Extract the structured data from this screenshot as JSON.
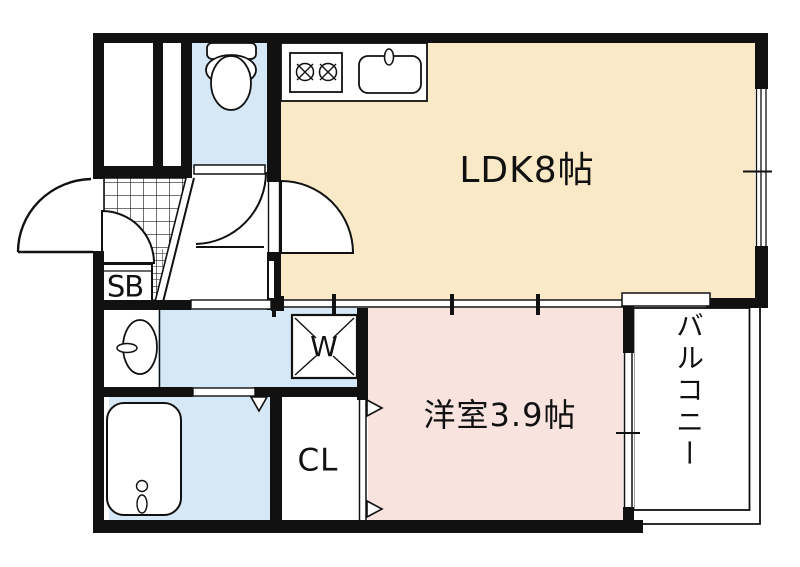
{
  "plan": {
    "type": "apartment-floor-plan",
    "colors": {
      "wall": "#111111",
      "ldk_floor": "#FAE9C6",
      "western_floor": "#F8E3DF",
      "wet_area_floor": "#D6E8F5",
      "fixture_fill": "#ffffff",
      "line": "#111111"
    },
    "rooms": {
      "ldk": {
        "label": "LDK8帖"
      },
      "western": {
        "label": "洋室3.9帖"
      },
      "balcony": {
        "label": "バルコニー"
      },
      "shoe_box": {
        "label": "SB"
      },
      "washer": {
        "label": "W"
      },
      "closet": {
        "label": "CL"
      }
    }
  }
}
